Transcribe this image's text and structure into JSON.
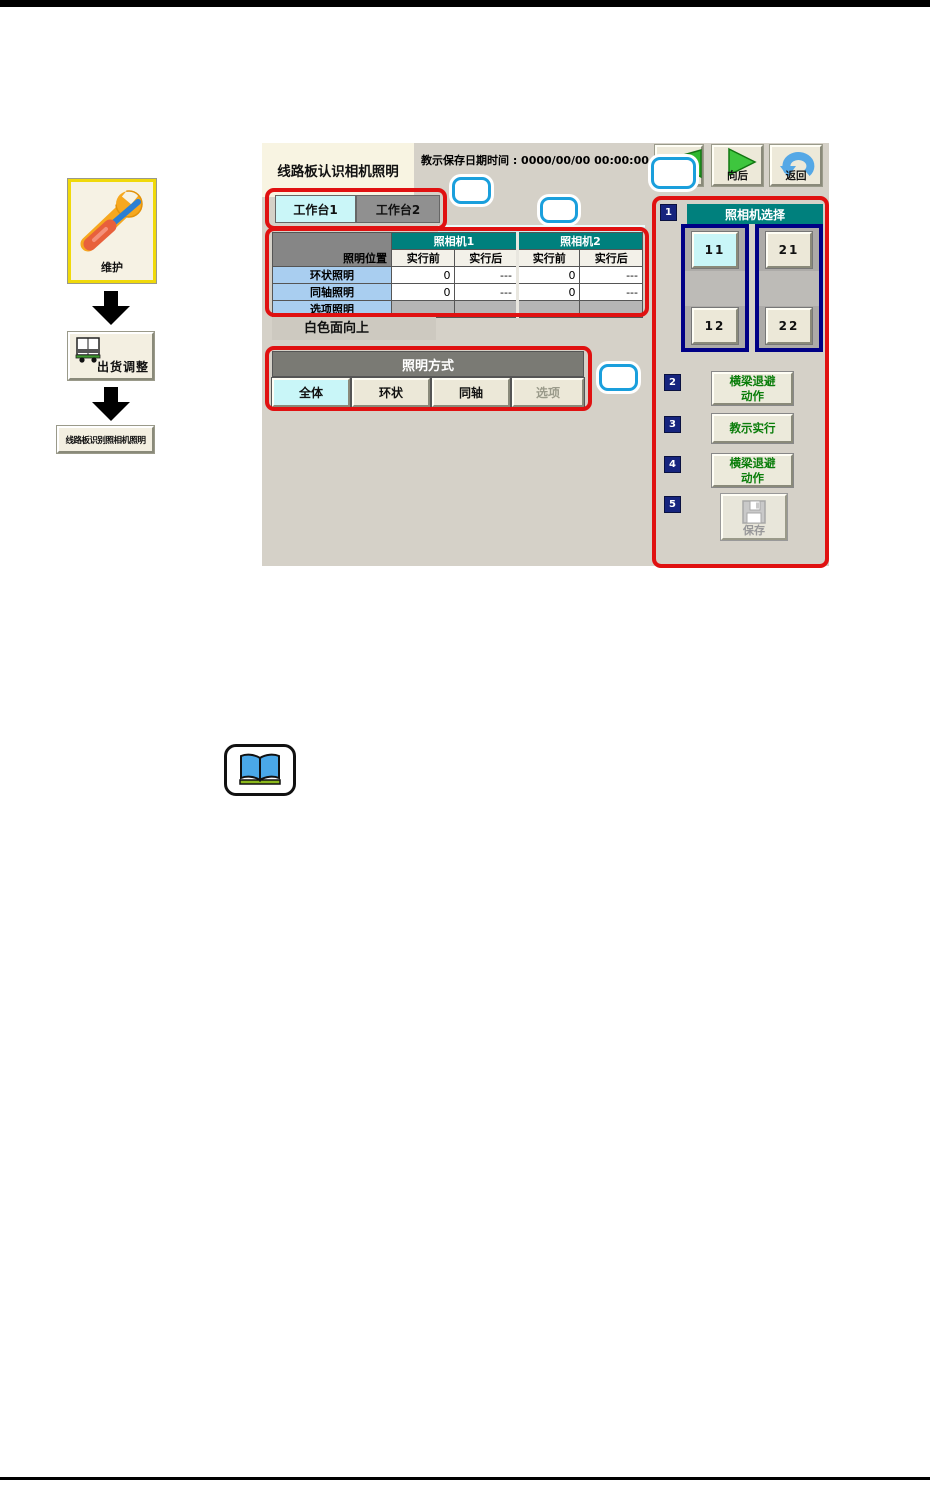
{
  "colors": {
    "annotation_red": "#e01111",
    "callout_blue": "#1a9fdc",
    "teal_header": "#00807d",
    "selected_cyan": "#c9f6f8",
    "step_navy": "#16247e",
    "grid_navy": "#000085",
    "button_green_text": "#0a7d0a",
    "screen_background": "#d5d1c8",
    "row_label_blue": "#a9cef0"
  },
  "sidebar": {
    "maintenance": {
      "label": "维护"
    },
    "shipment": {
      "label": "出货调整"
    },
    "board_item": {
      "label": "线路板识别照相机照明"
    }
  },
  "screen": {
    "title": "线路板认识相机照明",
    "save_datetime": "教示保存日期时间 : 0000/00/00 00:00:00",
    "nav": {
      "forward": "向后",
      "back": "返回"
    },
    "tabs": {
      "tab1": "工作台1",
      "tab2": "工作台2"
    },
    "table": {
      "corner": "照明位置",
      "camera1": "照相机1",
      "camera2": "照相机2",
      "sub": [
        "实行前",
        "实行后",
        "实行前",
        "实行后"
      ],
      "rows": [
        {
          "label": "环状照明",
          "values": [
            "0",
            "---",
            "0",
            "---"
          ]
        },
        {
          "label": "同轴照明",
          "values": [
            "0",
            "---",
            "0",
            "---"
          ]
        },
        {
          "label": "选项照明",
          "values": [
            "",
            "",
            "",
            ""
          ]
        }
      ]
    },
    "note": "白色面向上",
    "mode": {
      "header": "照明方式",
      "buttons": [
        "全体",
        "环状",
        "同轴",
        "选项"
      ]
    },
    "panel": {
      "step1": {
        "num": "1",
        "header": "照相机选择",
        "cam11": "11",
        "cam21": "21",
        "cam12": "12",
        "cam22": "22"
      },
      "step2": {
        "num": "2",
        "line1": "横梁退避",
        "line2": "动作"
      },
      "step3": {
        "num": "3",
        "label": "教示实行"
      },
      "step4": {
        "num": "4",
        "line1": "横梁退避",
        "line2": "动作"
      },
      "step5": {
        "num": "5",
        "label": "保存"
      }
    }
  }
}
